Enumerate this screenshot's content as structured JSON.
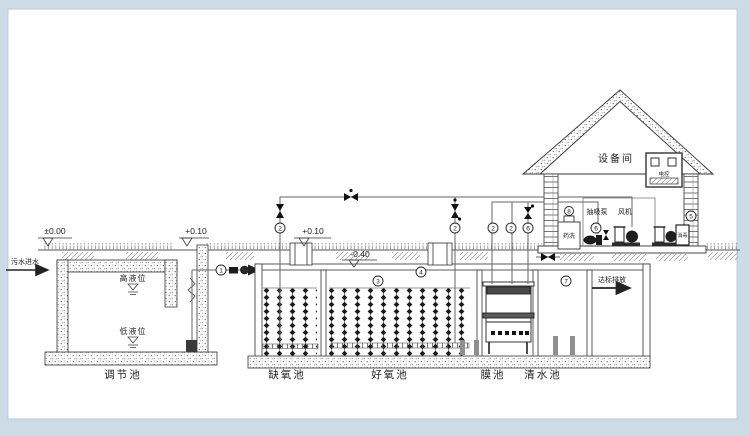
{
  "diagram": {
    "inlet_label": "污水进水",
    "outlet_label": "达标排放",
    "elevations": {
      "ground": "±0.00",
      "reg_top": "+0.10",
      "tank_top": "+0.10",
      "water": "-0.40"
    },
    "regulating_tank": {
      "label": "调节池",
      "high_level": "高液位",
      "low_level": "低液位"
    },
    "tanks": {
      "anoxic": "缺氧池",
      "aerobic": "好氧池",
      "membrane": "膜池",
      "clear_water": "清水池"
    },
    "equipment_room": {
      "label": "设备间",
      "panel": "电控",
      "suction_pump": "抽吸泵",
      "blower": "风机",
      "dosing_tank": "药洗",
      "disinfection": "消毒"
    },
    "callouts": {
      "lift_pump": "1",
      "valve1": "2",
      "valve2": "2",
      "valve3": "2",
      "valve4": "2",
      "media": "3",
      "aeration": "4",
      "blower_pipe": "5",
      "suction_line": "6",
      "suction_pump": "6",
      "clear_water": "7",
      "dosing": "8"
    }
  }
}
